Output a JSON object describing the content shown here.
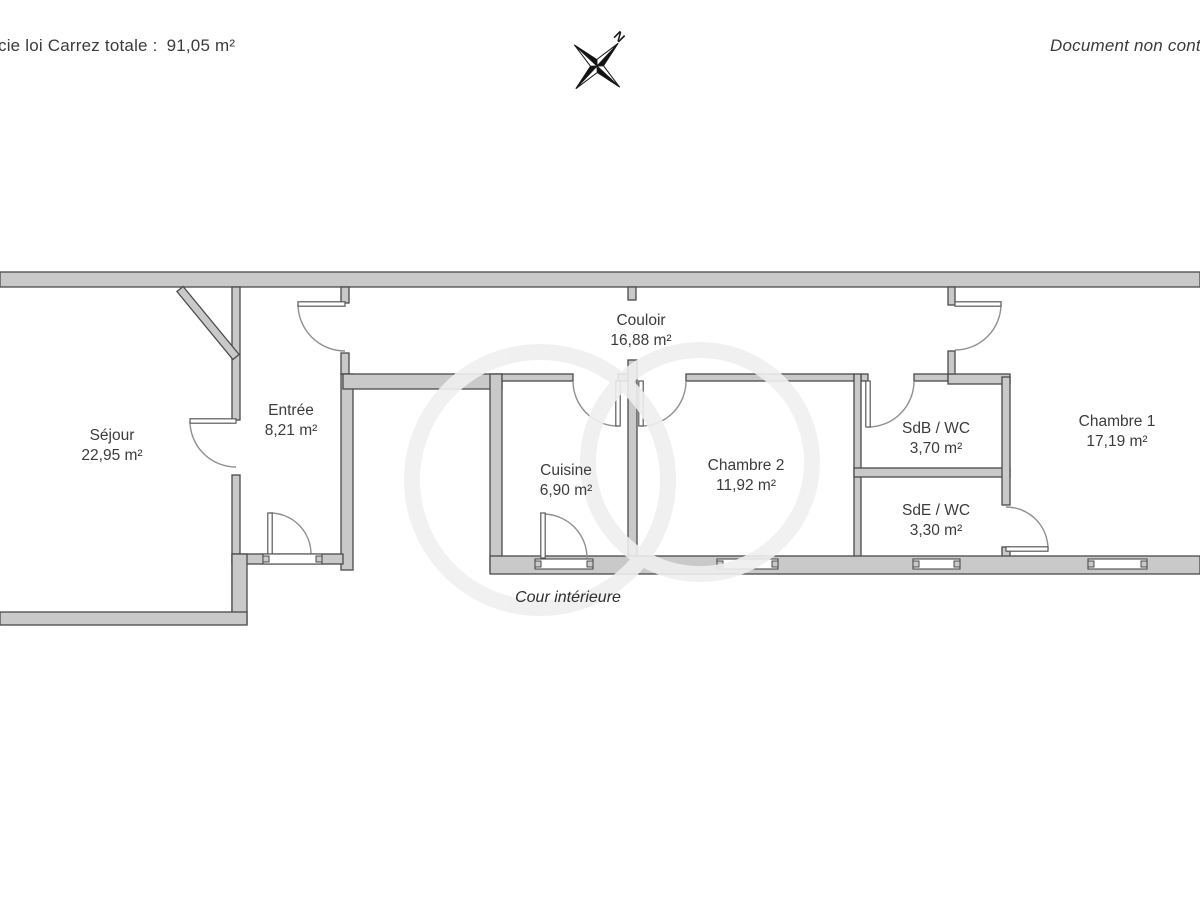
{
  "header": {
    "carrez_label": "cie loi Carrez totale :",
    "carrez_value": "91,05 m²",
    "disclaimer": "Document non contr",
    "north": "N"
  },
  "rooms": {
    "sejour": {
      "name": "Séjour",
      "area": "22,95 m²"
    },
    "entree": {
      "name": "Entrée",
      "area": "8,21 m²"
    },
    "couloir": {
      "name": "Couloir",
      "area": "16,88 m²"
    },
    "cuisine": {
      "name": "Cuisine",
      "area": "6,90 m²"
    },
    "chambre2": {
      "name": "Chambre 2",
      "area": "11,92 m²"
    },
    "sdb": {
      "name": "SdB / WC",
      "area": "3,70 m²"
    },
    "sde": {
      "name": "SdE / WC",
      "area": "3,30 m²"
    },
    "chambre1": {
      "name": "Chambre 1",
      "area": "17,19 m²"
    }
  },
  "outdoor": {
    "courtyard": "Cour intérieure"
  },
  "colors": {
    "wall_fill": "#c9c9c9",
    "wall_edge": "#4a4a4a",
    "door_arc": "#909090",
    "text": "#3c3c3c"
  }
}
